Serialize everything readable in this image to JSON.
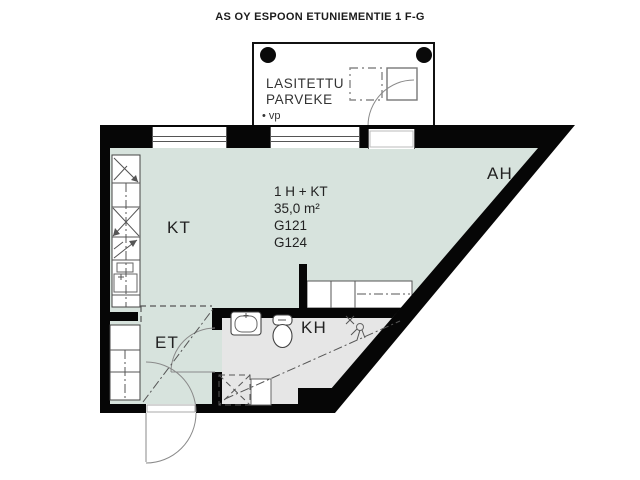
{
  "title": "AS OY ESPOON ETUNIEMENTIE 1 F-G",
  "balcony": {
    "name_line1": "LASITETTU",
    "name_line2": "PARVEKE",
    "note": "• vp"
  },
  "rooms": {
    "kitchen_living": "KT",
    "alcove": "AH",
    "bathroom": "KH",
    "entry": "ET"
  },
  "unit_info": {
    "layout": "1 H + KT",
    "area": "35,0 m²",
    "unit_code_1": "G121",
    "unit_code_2": "G124"
  },
  "colors": {
    "floor_main": "#d7e3dd",
    "floor_bath": "#e6e6e6",
    "wall": "#060606"
  }
}
